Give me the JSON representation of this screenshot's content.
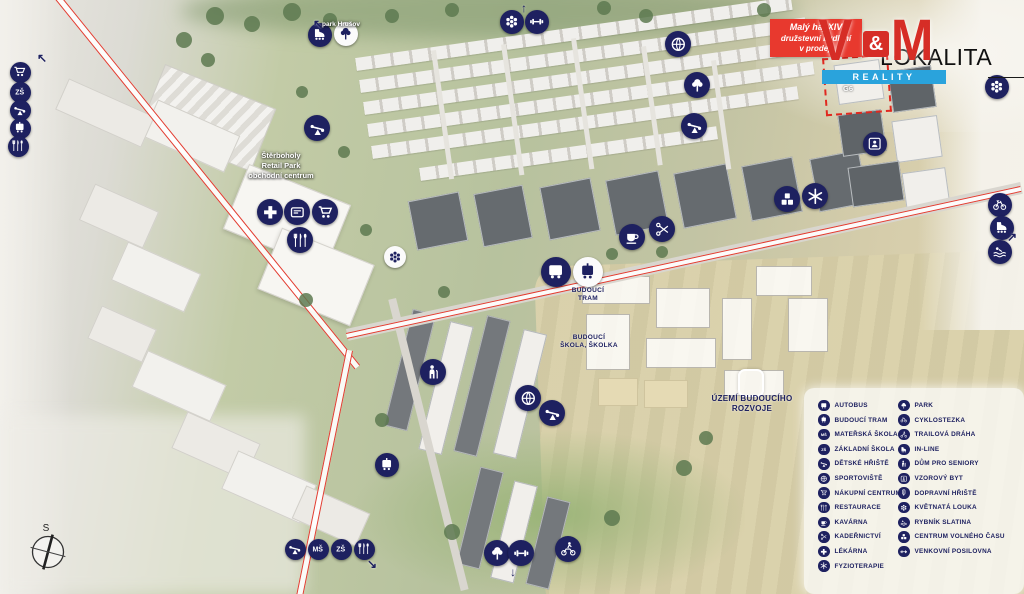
{
  "colors": {
    "navy": "#1e2160",
    "brand_red": "#d62d26",
    "promo_red": "#e8392e",
    "brand_blue": "#2aa3dc",
    "rail_red": "#e23c30",
    "ink": "#111111"
  },
  "branding": {
    "promo": {
      "line1": "Malý háj XIV",
      "line2": "družstevní bydlení",
      "line3": "v prodeji"
    },
    "logo": {
      "v": "V",
      "amp": "&",
      "m": "M",
      "subtitle": "REALITY"
    },
    "wordmark": "LOKALITA"
  },
  "highlight": {
    "label": "G6"
  },
  "compass": {
    "label": "S"
  },
  "icon_text": {
    "nursery": "MŠ",
    "primary": "ZŠ"
  },
  "map_labels": [
    {
      "name": "park-hrusov-label",
      "x": 341,
      "y": 21,
      "style": "white",
      "size": 6.5,
      "lines": [
        "park Hrušov"
      ]
    },
    {
      "name": "retail-park-label",
      "x": 281,
      "y": 151,
      "style": "white",
      "size": 7.5,
      "lines": [
        "Štěrboholy",
        "Retail Park",
        "obchodní centrum"
      ]
    },
    {
      "name": "future-tram-label",
      "x": 588,
      "y": 287,
      "style": "navy",
      "size": 6.5,
      "lines": [
        "BUDOUCÍ",
        "TRAM"
      ]
    },
    {
      "name": "future-school-label",
      "x": 589,
      "y": 334,
      "style": "navy",
      "size": 6.5,
      "lines": [
        "BUDOUCÍ",
        "ŠKOLA, ŠKOLKA"
      ]
    },
    {
      "name": "future-development-label",
      "x": 752,
      "y": 394,
      "style": "navy",
      "size": 8,
      "lines": [
        "ÚZEMÍ BUDOUCÍHO",
        "ROZVOJE"
      ]
    }
  ],
  "legend": {
    "columns": [
      {
        "items": [
          {
            "icon": "bus",
            "label": "AUTOBUS"
          },
          {
            "icon": "tram",
            "label": "BUDOUCÍ TRAM"
          },
          {
            "icon": "nursery-school",
            "label": "MATEŘSKÁ ŠKOLA"
          },
          {
            "icon": "primary-school",
            "label": "ZÁKLADNÍ ŠKOLA"
          },
          {
            "icon": "playground",
            "label": "DĚTSKÉ HŘIŠTĚ"
          },
          {
            "icon": "sports-ball",
            "label": "SPORTOVIŠTĚ"
          },
          {
            "icon": "shopping-cart",
            "label": "NÁKUPNÍ CENTRUM"
          },
          {
            "icon": "restaurant",
            "label": "RESTAURACE"
          },
          {
            "icon": "coffee",
            "label": "KAVÁRNA"
          },
          {
            "icon": "scissors",
            "label": "KADEŘNICTVÍ"
          },
          {
            "icon": "pharmacy-cross",
            "label": "LÉKÁRNA"
          },
          {
            "icon": "physio-star",
            "label": "FYZIOTERAPIE"
          }
        ]
      },
      {
        "items": [
          {
            "icon": "park-tree",
            "label": "PARK"
          },
          {
            "icon": "bicycle",
            "label": "CYKLOSTEZKA"
          },
          {
            "icon": "trail-bike",
            "label": "TRAILOVÁ DRÁHA"
          },
          {
            "icon": "inline-skate",
            "label": "IN-LINE"
          },
          {
            "icon": "senior",
            "label": "DŮM PRO SENIORY"
          },
          {
            "icon": "model-flat",
            "label": "VZOROVÝ BYT"
          },
          {
            "icon": "traffic-light",
            "label": "DOPRAVNÍ HŘIŠTĚ"
          },
          {
            "icon": "flower",
            "label": "KVĚTNATÁ LOUKA"
          },
          {
            "icon": "swimmer",
            "label": "RYBNÍK SLATINA"
          },
          {
            "icon": "toy-blocks",
            "label": "CENTRUM VOLNÉHO ČASU"
          },
          {
            "icon": "dumbbell",
            "label": "VENKOVNÍ POSILOVNA"
          }
        ]
      }
    ]
  },
  "map_icons": [
    {
      "x": 20,
      "y": 72,
      "type": "shopping-cart",
      "variant": "navy",
      "size": 21
    },
    {
      "x": 20,
      "y": 92,
      "type": "primary-school",
      "variant": "navy",
      "size": 21
    },
    {
      "x": 20,
      "y": 110,
      "type": "playground",
      "variant": "navy",
      "size": 21
    },
    {
      "x": 20,
      "y": 128,
      "type": "tram",
      "variant": "navy",
      "size": 21
    },
    {
      "x": 18,
      "y": 146,
      "type": "restaurant",
      "variant": "navy",
      "size": 21
    },
    {
      "x": 320,
      "y": 35,
      "type": "inline-skate",
      "variant": "navy",
      "size": 24
    },
    {
      "x": 346,
      "y": 34,
      "type": "park-tree",
      "variant": "white",
      "size": 24
    },
    {
      "x": 317,
      "y": 128,
      "type": "playground",
      "variant": "navy",
      "size": 26
    },
    {
      "x": 270,
      "y": 212,
      "type": "pharmacy-cross",
      "variant": "navy",
      "size": 26
    },
    {
      "x": 297,
      "y": 212,
      "type": "atm",
      "variant": "navy",
      "size": 26
    },
    {
      "x": 325,
      "y": 212,
      "type": "shopping-cart",
      "variant": "navy",
      "size": 26
    },
    {
      "x": 300,
      "y": 240,
      "type": "restaurant",
      "variant": "navy",
      "size": 26
    },
    {
      "x": 512,
      "y": 22,
      "type": "flower",
      "variant": "navy",
      "size": 24
    },
    {
      "x": 537,
      "y": 22,
      "type": "dumbbell",
      "variant": "navy",
      "size": 24
    },
    {
      "x": 678,
      "y": 44,
      "type": "sports-ball",
      "variant": "navy",
      "size": 26
    },
    {
      "x": 697,
      "y": 85,
      "type": "park-tree",
      "variant": "navy",
      "size": 26
    },
    {
      "x": 694,
      "y": 126,
      "type": "playground",
      "variant": "navy",
      "size": 26
    },
    {
      "x": 556,
      "y": 272,
      "type": "bus",
      "variant": "navy",
      "size": 30
    },
    {
      "x": 588,
      "y": 272,
      "type": "tram",
      "variant": "white",
      "size": 30
    },
    {
      "x": 632,
      "y": 237,
      "type": "coffee",
      "variant": "navy",
      "size": 26
    },
    {
      "x": 662,
      "y": 229,
      "type": "scissors",
      "variant": "navy",
      "size": 26
    },
    {
      "x": 787,
      "y": 199,
      "type": "toy-blocks",
      "variant": "navy",
      "size": 26
    },
    {
      "x": 815,
      "y": 196,
      "type": "physio-star",
      "variant": "navy",
      "size": 26
    },
    {
      "x": 875,
      "y": 144,
      "type": "model-flat",
      "variant": "navy",
      "size": 24
    },
    {
      "x": 997,
      "y": 87,
      "type": "flower",
      "variant": "navy",
      "size": 24
    },
    {
      "x": 1000,
      "y": 205,
      "type": "bicycle",
      "variant": "navy",
      "size": 24
    },
    {
      "x": 1002,
      "y": 228,
      "type": "inline-skate",
      "variant": "navy",
      "size": 24
    },
    {
      "x": 1000,
      "y": 252,
      "type": "swimmer",
      "variant": "navy",
      "size": 24
    },
    {
      "x": 433,
      "y": 372,
      "type": "senior",
      "variant": "navy",
      "size": 26
    },
    {
      "x": 528,
      "y": 398,
      "type": "sports-ball",
      "variant": "navy",
      "size": 26
    },
    {
      "x": 552,
      "y": 413,
      "type": "playground",
      "variant": "navy",
      "size": 26
    },
    {
      "x": 387,
      "y": 465,
      "type": "tram",
      "variant": "navy",
      "size": 24
    },
    {
      "x": 295,
      "y": 549,
      "type": "playground",
      "variant": "navy",
      "size": 21
    },
    {
      "x": 318,
      "y": 549,
      "type": "nursery-school",
      "variant": "navy",
      "size": 21
    },
    {
      "x": 341,
      "y": 549,
      "type": "primary-school",
      "variant": "navy",
      "size": 21
    },
    {
      "x": 364,
      "y": 549,
      "type": "restaurant",
      "variant": "navy",
      "size": 21
    },
    {
      "x": 497,
      "y": 553,
      "type": "park-tree",
      "variant": "navy",
      "size": 26
    },
    {
      "x": 521,
      "y": 553,
      "type": "dumbbell",
      "variant": "navy",
      "size": 26
    },
    {
      "x": 568,
      "y": 549,
      "type": "trail-bike",
      "variant": "navy",
      "size": 26
    },
    {
      "x": 395,
      "y": 257,
      "type": "flower",
      "variant": "white",
      "size": 22
    }
  ],
  "map_arrows": [
    {
      "x": 42,
      "y": 58,
      "glyph": "↖"
    },
    {
      "x": 318,
      "y": 24,
      "glyph": "↖"
    },
    {
      "x": 524,
      "y": 8,
      "glyph": "↑"
    },
    {
      "x": 1012,
      "y": 237,
      "glyph": "↗"
    },
    {
      "x": 372,
      "y": 564,
      "glyph": "↘"
    },
    {
      "x": 513,
      "y": 572,
      "glyph": "↓"
    }
  ]
}
